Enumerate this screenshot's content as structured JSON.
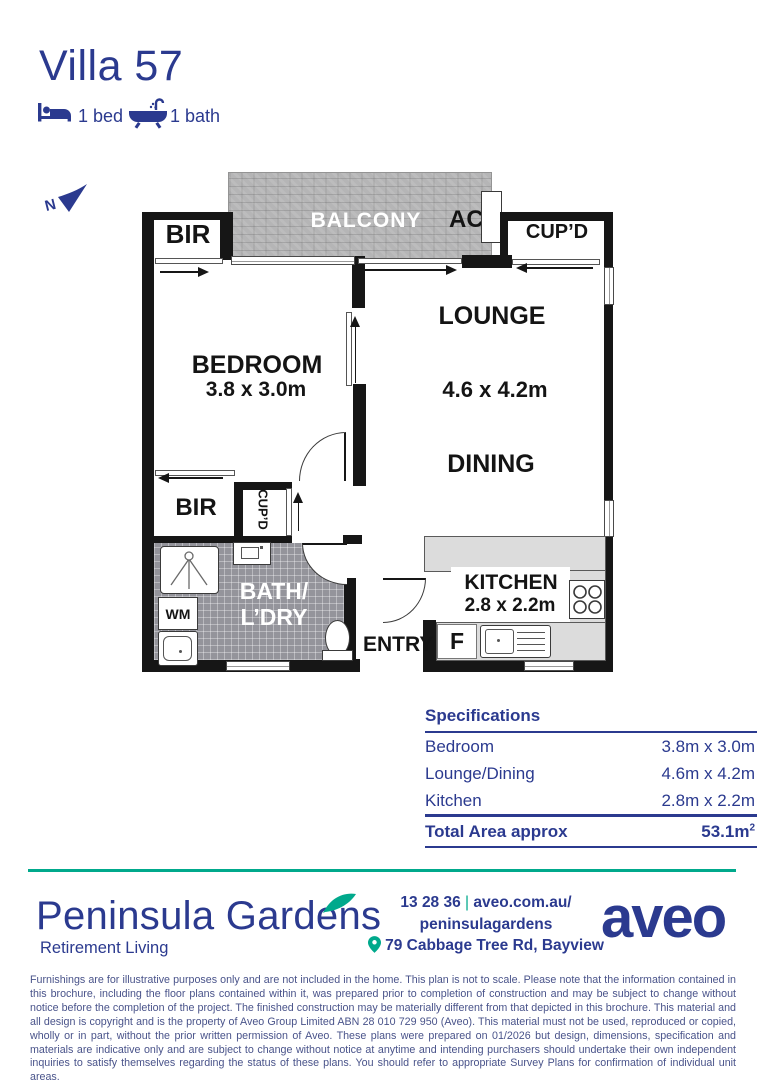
{
  "header": {
    "title": "Villa 57",
    "bed_label": "1 bed",
    "bath_label": "1 bath"
  },
  "compass": {
    "label": "N"
  },
  "plan": {
    "balcony": "BALCONY",
    "ac": "AC",
    "cupd_top": "CUP’D",
    "bir_top": "BIR",
    "bedroom": "BEDROOM",
    "bedroom_dims": "3.8 x 3.0m",
    "lounge": "LOUNGE",
    "lounge_dims": "4.6 x 4.2m",
    "dining": "DINING",
    "bir_bottom": "BIR",
    "cupd_bottom": "CUP’D",
    "bath_line1": "BATH/",
    "bath_line2": "L’DRY",
    "wm": "WM",
    "entry": "ENTRY",
    "kitchen": "KITCHEN",
    "kitchen_dims": "2.8 x 2.2m",
    "fridge": "F"
  },
  "specifications": {
    "title": "Specifications",
    "rows": [
      {
        "label": "Bedroom",
        "value": "3.8m x 3.0m"
      },
      {
        "label": "Lounge/Dining",
        "value": "4.6m x 4.2m"
      },
      {
        "label": "Kitchen",
        "value": "2.8m x 2.2m"
      }
    ],
    "total_label": "Total Area approx",
    "total_value": "53.1m",
    "total_sup": "2"
  },
  "footer": {
    "community_name": "Peninsula Gardens",
    "community_subtitle": "Retirement Living",
    "contact": {
      "phone": "13 28 36",
      "separator": "|",
      "url": "aveo.com.au/",
      "handle": "peninsulagardens",
      "address": "79 Cabbage Tree Rd, Bayview"
    },
    "brand": "aveo"
  },
  "disclaimer": "Furnishings are for illustrative purposes only and are not included in the home. This plan is not to scale. Please note that the information contained in this brochure, including the floor plans contained within it, was prepared prior to completion of construction and may be subject to change without notice before the completion of the project. The finished construction may be materially different from that depicted in this brochure. This material and all design is copyright and is the property of Aveo Group Limited ABN 28 010 729 950 (Aveo). This material must not be used, reproduced or copied, wholly or in part, without the prior written permission of Aveo. These plans were prepared on 01/2026 but design, dimensions, specification and materials are indicative only and are subject to change without notice at anytime and intending purchasers should undertake their own independent inquiries to satisfy themselves regarding the status of these plans. You should refer to appropriate Survey Plans for confirmation of individual unit areas.",
  "colors": {
    "navy": "#2b3a8f",
    "teal": "#00a98c",
    "wall": "#161616"
  }
}
